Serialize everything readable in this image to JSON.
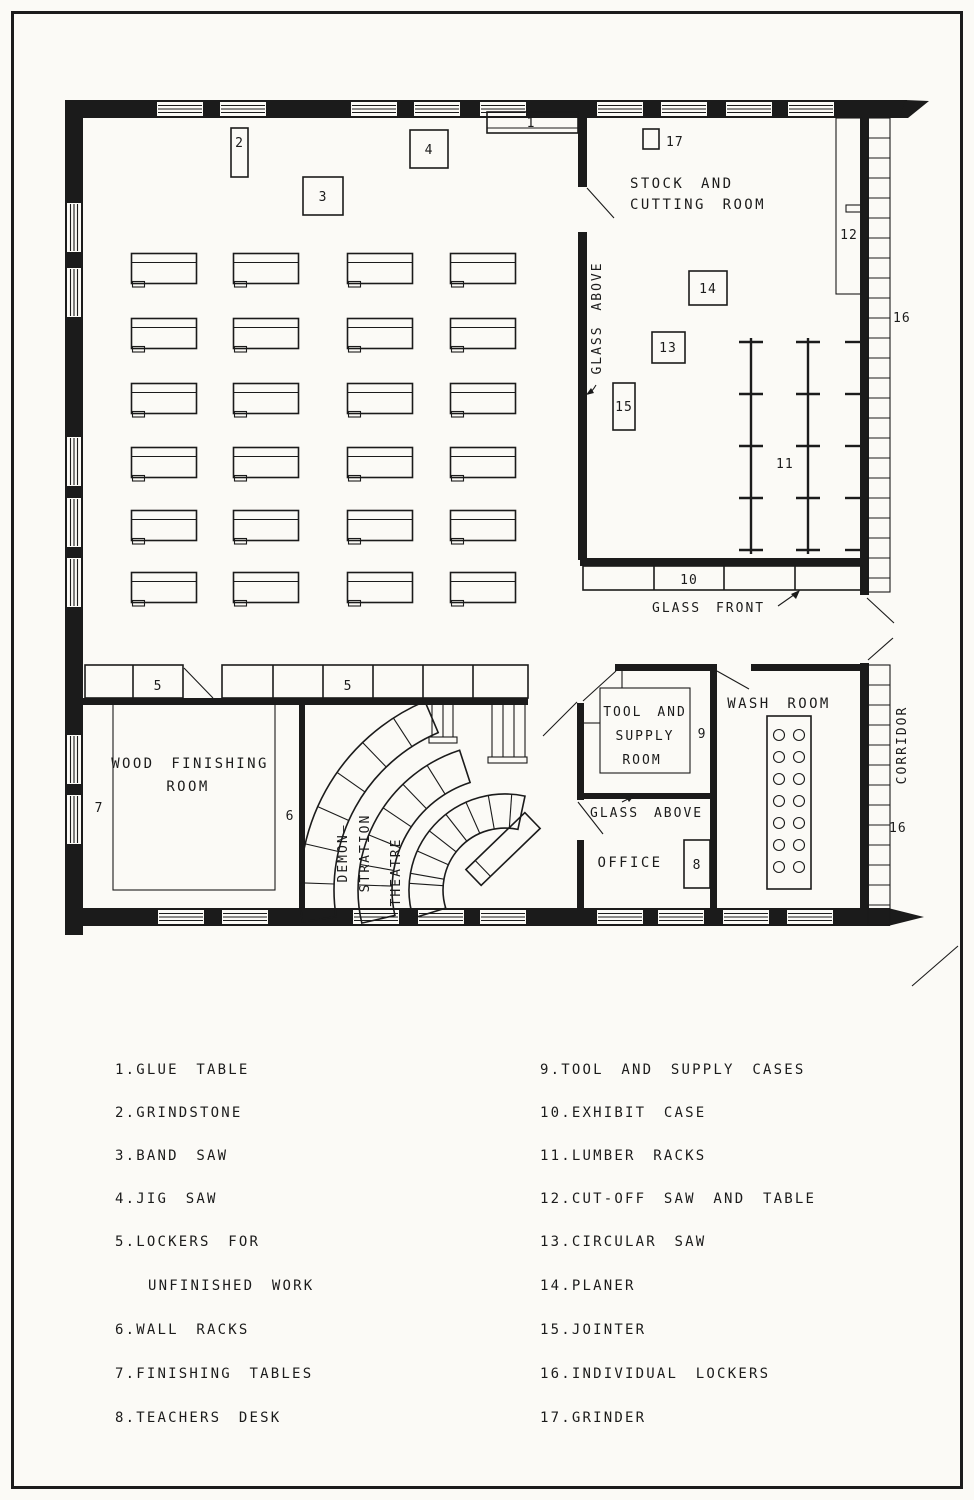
{
  "figure": {
    "kind": "woodworking-shop-floor-plan"
  },
  "colors": {
    "ink": "#1b1b1b",
    "paper": "#fbfaf6"
  },
  "plan": {
    "rooms": {
      "stock_cutting_line1": "STOCK AND",
      "stock_cutting_line2": "CUTTING ROOM",
      "wood_finishing_line1": "WOOD FINISHING",
      "wood_finishing_line2": "ROOM",
      "demo_line1": "DEMON—",
      "demo_line2": "STRATION",
      "demo_line3": "THEATRE",
      "tool_line1": "TOOL AND",
      "tool_line2": "SUPPLY",
      "tool_line3": "ROOM",
      "office": "OFFICE",
      "wash_room": "WASH ROOM",
      "corridor": "CORRIDOR"
    },
    "annotations": {
      "glass_above_wall": "GLASS ABOVE",
      "glass_above_office": "GLASS ABOVE",
      "glass_front": "GLASS FRONT"
    },
    "markers": {
      "n1": "1",
      "n2": "2",
      "n3": "3",
      "n4": "4",
      "n5a": "5",
      "n5b": "5",
      "n6": "6",
      "n7": "7",
      "n8": "8",
      "n9": "9",
      "n10": "10",
      "n11": "11",
      "n12": "12",
      "n13": "13",
      "n14": "14",
      "n15": "15",
      "n16a": "16",
      "n16b": "16",
      "n17": "17"
    }
  },
  "legend": {
    "left": [
      "1.GLUE TABLE",
      "2.GRINDSTONE",
      "3.BAND SAW",
      "4.JIG SAW",
      "5.LOCKERS FOR",
      "UNFINISHED WORK",
      "6.WALL RACKS",
      "7.FINISHING TABLES",
      "8.TEACHERS DESK"
    ],
    "right": [
      "9.TOOL AND SUPPLY CASES",
      "10.EXHIBIT CASE",
      "11.LUMBER RACKS",
      "12.CUT-OFF SAW AND TABLE",
      "13.CIRCULAR SAW",
      "14.PLANER",
      "15.JOINTER",
      "16.INDIVIDUAL LOCKERS",
      "17.GRINDER"
    ]
  }
}
